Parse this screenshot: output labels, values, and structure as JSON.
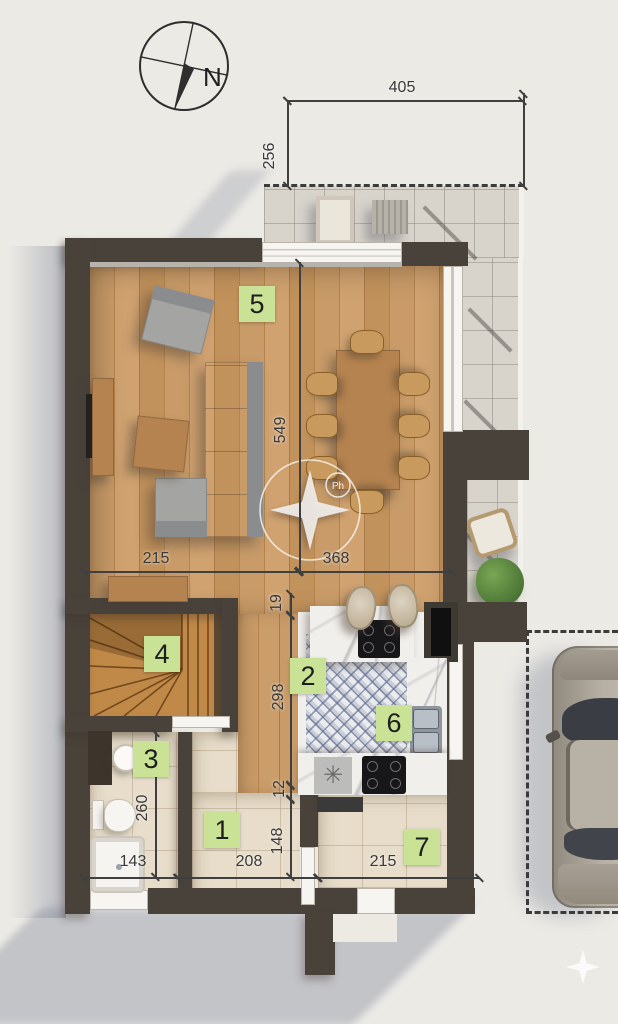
{
  "compass": {
    "label": "N"
  },
  "watermark": {
    "badge": "Ph"
  },
  "kitchen": {
    "mat_symbol": "✳"
  },
  "room_labels": [
    {
      "num": "1"
    },
    {
      "num": "2"
    },
    {
      "num": "3"
    },
    {
      "num": "4"
    },
    {
      "num": "5"
    },
    {
      "num": "6"
    },
    {
      "num": "7"
    }
  ],
  "dimensions": [
    {
      "value": "405",
      "axis": "horizontal"
    },
    {
      "value": "256",
      "axis": "vertical"
    },
    {
      "value": "549",
      "axis": "vertical"
    },
    {
      "value": "215",
      "axis": "horizontal"
    },
    {
      "value": "368",
      "axis": "horizontal"
    },
    {
      "value": "19",
      "axis": "vertical"
    },
    {
      "value": "298",
      "axis": "vertical"
    },
    {
      "value": "12",
      "axis": "vertical"
    },
    {
      "value": "148",
      "axis": "vertical"
    },
    {
      "value": "260",
      "axis": "vertical"
    },
    {
      "value": "143",
      "axis": "horizontal"
    },
    {
      "value": "208",
      "axis": "horizontal"
    },
    {
      "value": "215",
      "axis": "horizontal"
    }
  ],
  "colors": {
    "wall": "#49423b",
    "room_label_bg": "#c9e296",
    "wood_floor": "#c79a66",
    "kitchen_tile_accent": "#5866a0",
    "terrace_tile": "#d8d4cc",
    "bath_tile": "#e7ddca",
    "dimension_text": "#3a3a3a",
    "background": "#eceae5"
  }
}
